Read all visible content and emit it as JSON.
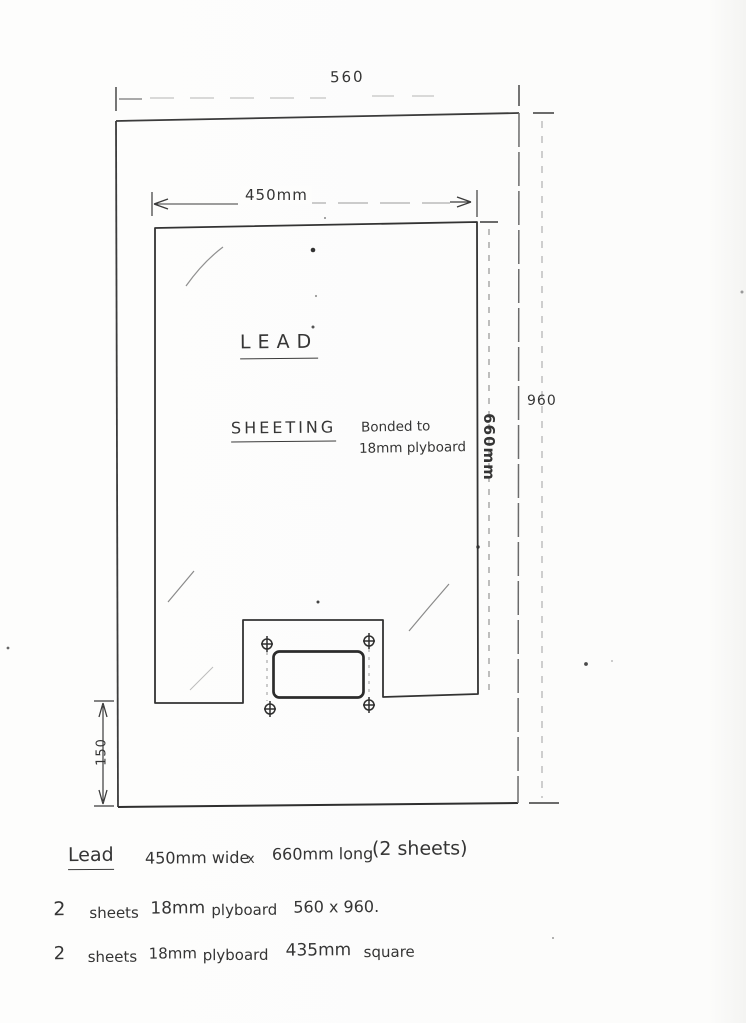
{
  "colors": {
    "paper": "#fcfcfb",
    "ink": "#3b3b3b",
    "faint": "#9a9a9a"
  },
  "dimensions": {
    "outer_width": "560",
    "inner_width": "450mm",
    "inner_height": "660mm",
    "outer_height": "960",
    "bottom_margin": "150"
  },
  "sheet": {
    "title_line1": "LEAD",
    "title_line2": "SHEETING"
  },
  "bonded_note": {
    "line1": "Bonded to",
    "line2": "18mm plyboard"
  },
  "notes": {
    "line1": {
      "title": "Lead",
      "spec": "450mm wide",
      "x": "x",
      "spec2": "660mm long",
      "qty": "(2 sheets)"
    },
    "line2": {
      "qty": "2",
      "item": "sheets",
      "thickness": "18mm",
      "material": "plyboard",
      "size": "560 x 960."
    },
    "line3": {
      "qty": "2",
      "item": "sheets",
      "thickness": "18mm",
      "material": "plyboard",
      "size": "435mm",
      "shape": "square"
    }
  }
}
